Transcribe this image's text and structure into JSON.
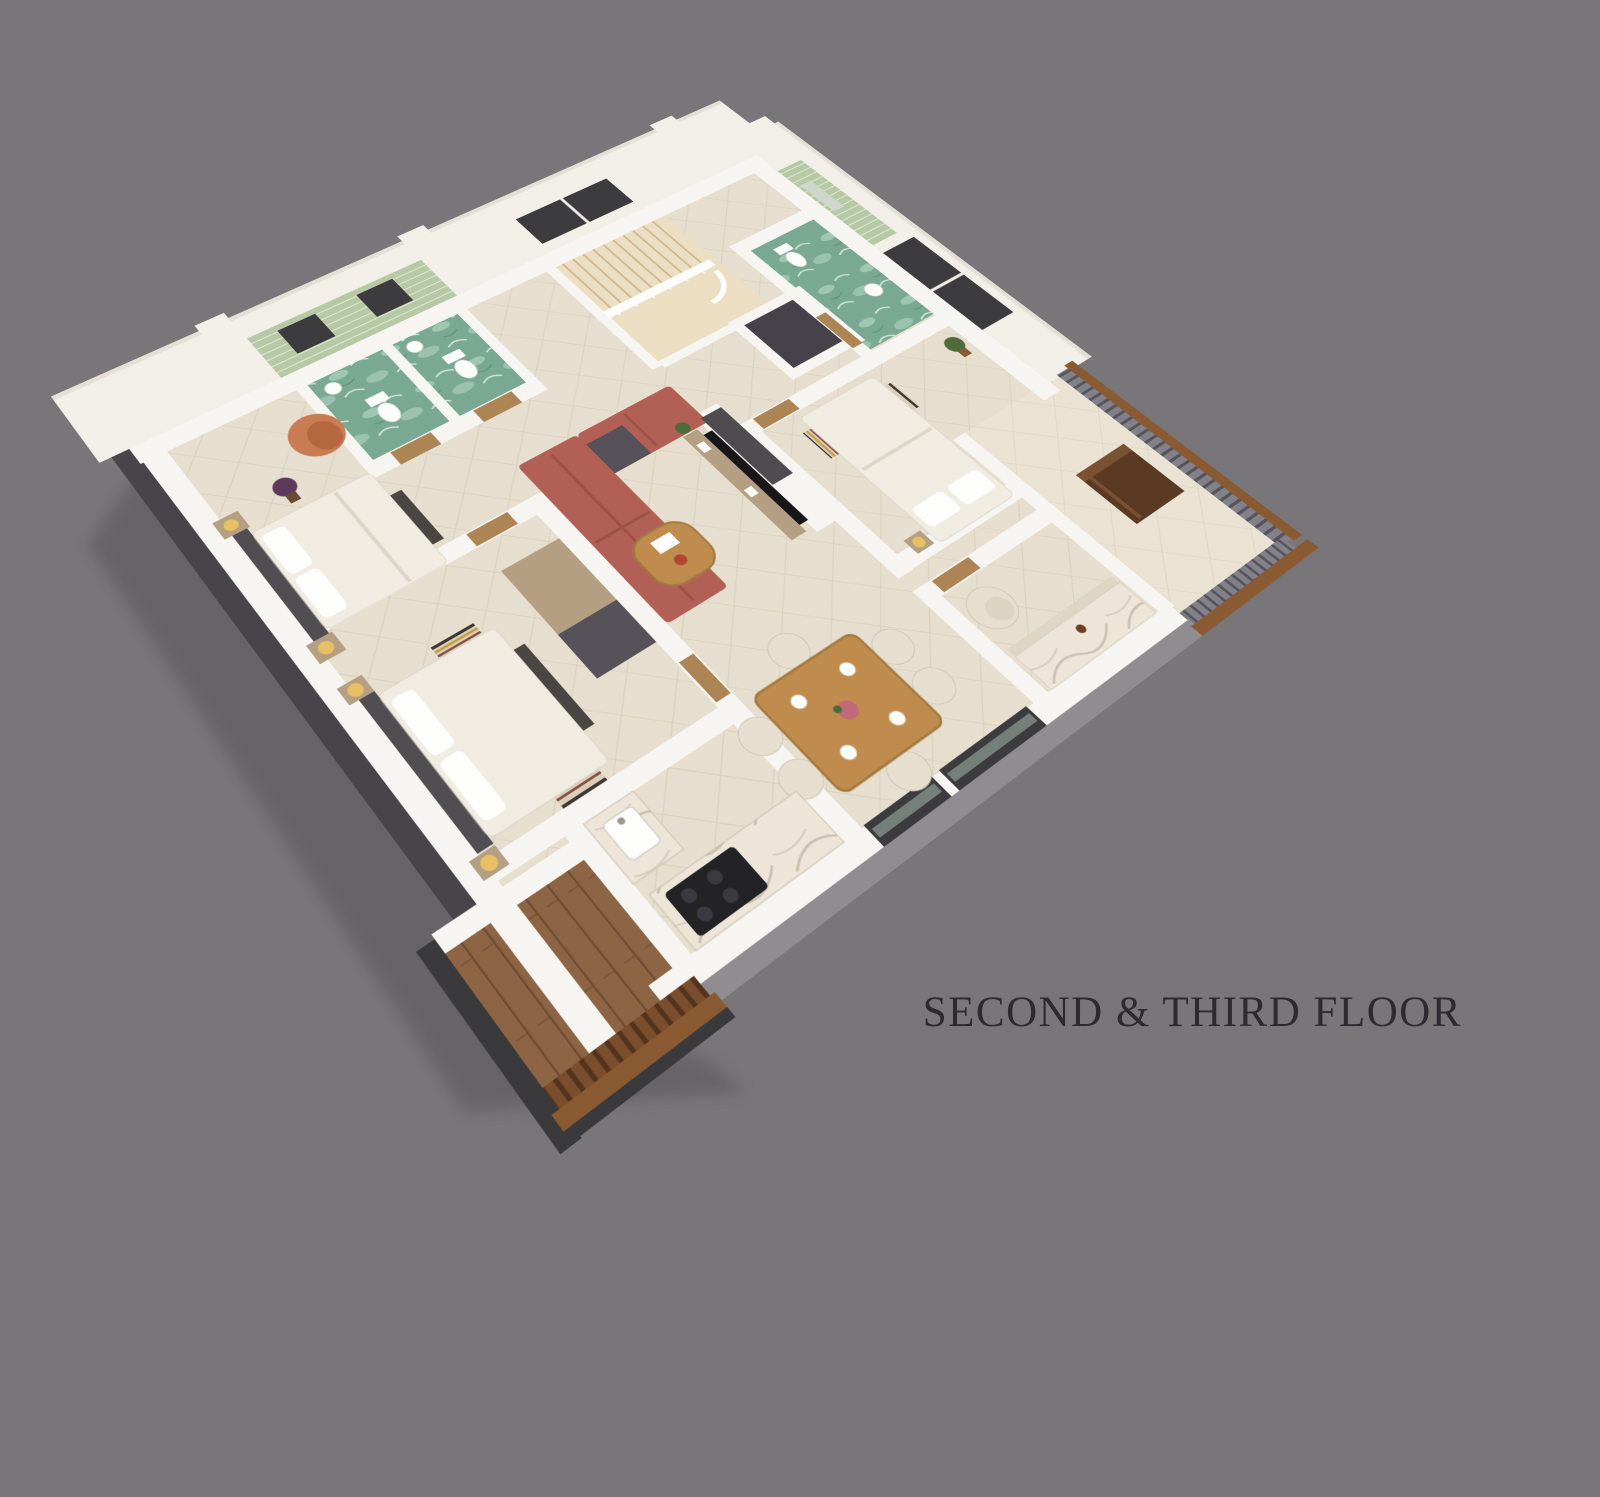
{
  "title": {
    "label": "SECOND & THIRD FLOOR"
  },
  "scene": {
    "type": "3d-isometric-floor-plan-render",
    "view": "rotated top-down axonometric, apartment cutaway on plain gray backdrop",
    "rooms": [
      {
        "name": "bedroom-upper-left",
        "contents": [
          "egg-lounge-chair",
          "double-bed",
          "dark-headboard-wall",
          "bedside-lamps",
          "purple-potted-plant"
        ]
      },
      {
        "name": "bathroom-1",
        "contents": [
          "toilet",
          "washbasin",
          "green-tiled-wall",
          "teal-marble-floor",
          "small-window"
        ]
      },
      {
        "name": "bathroom-2",
        "contents": [
          "toilet",
          "washbasin",
          "green-tiled-wall",
          "teal-marble-floor",
          "small-window"
        ]
      },
      {
        "name": "stair-hall",
        "contents": [
          "wood-staircase",
          "white-railing",
          "dark-window"
        ]
      },
      {
        "name": "elevator-shaft",
        "contents": [
          "dark-gray-shaft"
        ]
      },
      {
        "name": "bathroom-3",
        "contents": [
          "pedestal-washbasin",
          "mirror",
          "green-tiled-wall",
          "teal-marble-floor",
          "wood-door"
        ]
      },
      {
        "name": "bedroom-right",
        "contents": [
          "double-bed",
          "striped-runner",
          "dark-window",
          "potted-plant",
          "wood-door"
        ]
      },
      {
        "name": "living-room",
        "contents": [
          "l-shaped-terracotta-sofa",
          "round-coffee-table",
          "tv-panel-wall",
          "media-shelf",
          "murphy-cabinet"
        ]
      },
      {
        "name": "bedroom-lower-left",
        "contents": [
          "double-bed",
          "striped-runner",
          "bedside-lamps",
          "foot-bench"
        ]
      },
      {
        "name": "dining-area",
        "contents": [
          "wood-dining-table",
          "six-cream-chairs",
          "place-settings",
          "flower-centerpiece",
          "glass-windows"
        ]
      },
      {
        "name": "kitchen",
        "contents": [
          "l-shaped-marble-counter",
          "sink",
          "black-gas-cooktop"
        ]
      },
      {
        "name": "study-room",
        "contents": [
          "cream-armchair",
          "marble-vanity-counter",
          "wood-door"
        ]
      },
      {
        "name": "east-balcony",
        "contents": [
          "dark-wood-desk",
          "slat-railing-with-wood-cap"
        ]
      },
      {
        "name": "south-deck",
        "contents": [
          "wood-plank-floor",
          "wood-railing"
        ]
      }
    ]
  },
  "colors": {
    "bg": "#787678",
    "shadow": "#59575a",
    "wall": "#f7f5f1",
    "wall_tall": "#f2efe9",
    "wall_cap": "#e4e0d8",
    "outer_dark": "#47454a",
    "outer_gray": "#8f8d8f",
    "floor": "#e6dfcf",
    "floor_line": "#c0ae8e",
    "wood_floor": "#ebdec2",
    "bath_floor": "#79a893",
    "bath_floor2": "#a9cdb8",
    "bath_tile": "#b7c8a4",
    "window_dark": "#3c3b3e",
    "deck": "#8d6544",
    "deck_line": "#6f4c33",
    "sofa": "#b26055",
    "sofa_line": "#9d5149",
    "bed": "#f0ece2",
    "headboard": "#514e52",
    "cabinet_tan": "#b49f83",
    "cabinet_dark": "#57525a",
    "table_wood": "#c08c4e",
    "seat_cream": "#e6dfd0",
    "counter_marble": "#ece5d8",
    "cooktop": "#232326",
    "desk_wood": "#5a3a22",
    "railing_slat": "#82818a",
    "railing_wood": "#8a5a33",
    "lamp": "#e8c064",
    "plant": "#4e6b3a",
    "plant_purple": "#5c3a5e",
    "chair_orange": "#c97c52",
    "elevator": "#454349",
    "tv": "#17171a",
    "title_text": "#2c2c30"
  }
}
